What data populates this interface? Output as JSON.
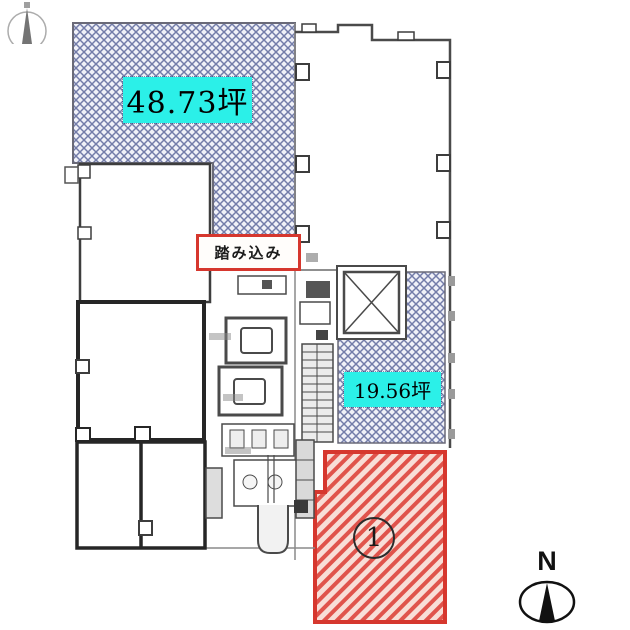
{
  "plan": {
    "areas": {
      "area_large": {
        "label": "48.73坪",
        "fill": "#2bf0e8",
        "hatch": "blue-crosshatch"
      },
      "area_small": {
        "label": "19.56坪",
        "fill": "#2bf0e8",
        "hatch": "blue-crosshatch"
      },
      "unit": {
        "label": "①",
        "digit": "1",
        "hatch": "red-diagonal"
      },
      "vestibule": {
        "label": "踏み込み",
        "border_color": "#d6372e"
      }
    },
    "compass": {
      "north_label": "N"
    },
    "colors": {
      "blue_hatch_line": "#737ca9",
      "blue_hatch_bg": "#f0f1f8",
      "red_hatch_line": "#e0544c",
      "red_hatch_bg": "#f8ded7",
      "red_border": "#d6372e",
      "label_bg": "#2bf0e8",
      "wall": "#3d3d3d"
    }
  }
}
